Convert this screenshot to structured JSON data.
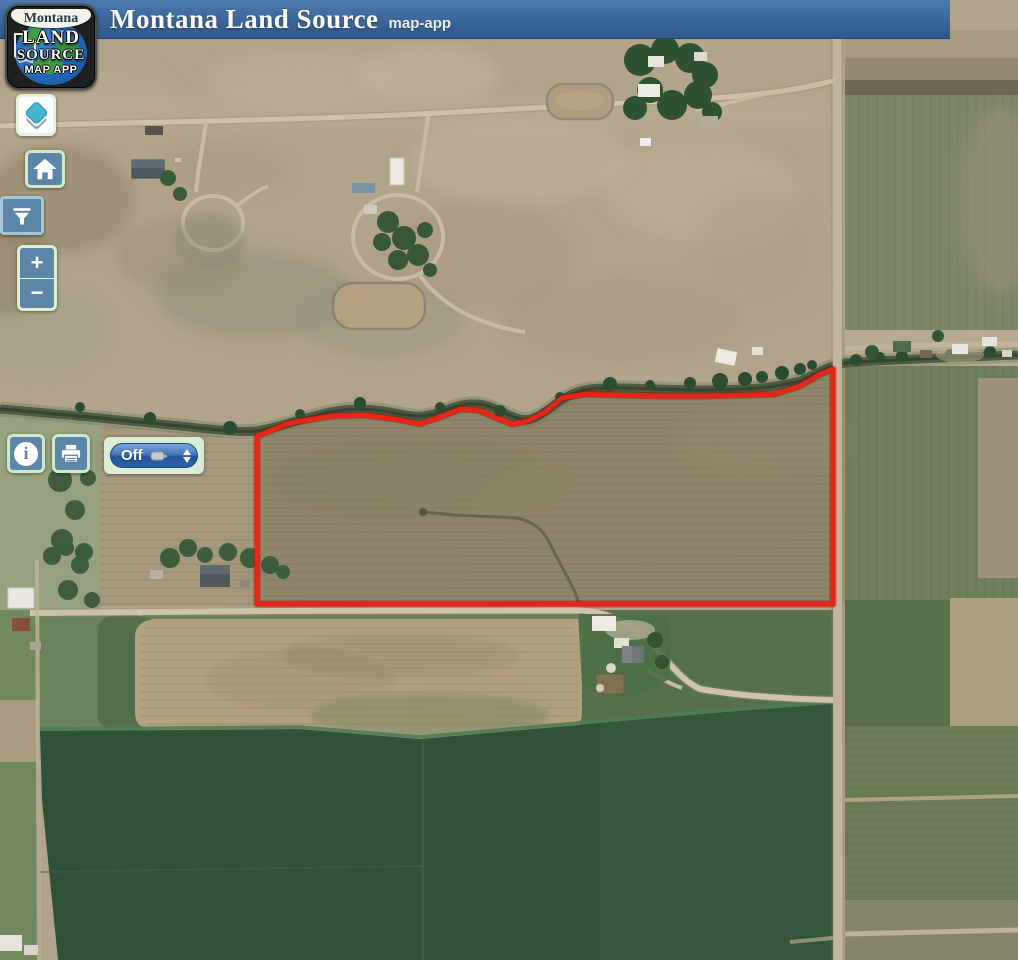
{
  "header": {
    "title": "Montana Land Source",
    "app_label": "map-app",
    "bg_color": "#3a6699"
  },
  "logo": {
    "region": "Montana",
    "land": "LAND",
    "source": "SOURCE",
    "map_app": "MAP APP"
  },
  "controls": {
    "zoom_in_label": "+",
    "zoom_out_label": "−",
    "info_glyph": "i",
    "measure_value": "Off",
    "buttons": [
      {
        "name": "layers",
        "icon": "layers-icon"
      },
      {
        "name": "home",
        "icon": "home-icon"
      },
      {
        "name": "filter",
        "icon": "filter-icon"
      },
      {
        "name": "zoom-in",
        "icon": "plus-glyph"
      },
      {
        "name": "zoom-out",
        "icon": "minus-glyph"
      },
      {
        "name": "info",
        "icon": "info-icon"
      },
      {
        "name": "print",
        "icon": "printer-icon"
      },
      {
        "name": "measure-select",
        "icon": "measure-tape-icon"
      }
    ]
  },
  "map": {
    "type": "satellite-imagery",
    "overlay": "parcel-boundary-polygon",
    "boundary_color": "#ea2417"
  },
  "colors": {
    "button_slate": "#5b86a8",
    "pale_green_border": "#d8eed2",
    "select_blue_top": "#7aa7d6",
    "select_blue_bottom": "#24549b",
    "header_blue": "#3a6699",
    "boundary_red": "#ea2417"
  }
}
